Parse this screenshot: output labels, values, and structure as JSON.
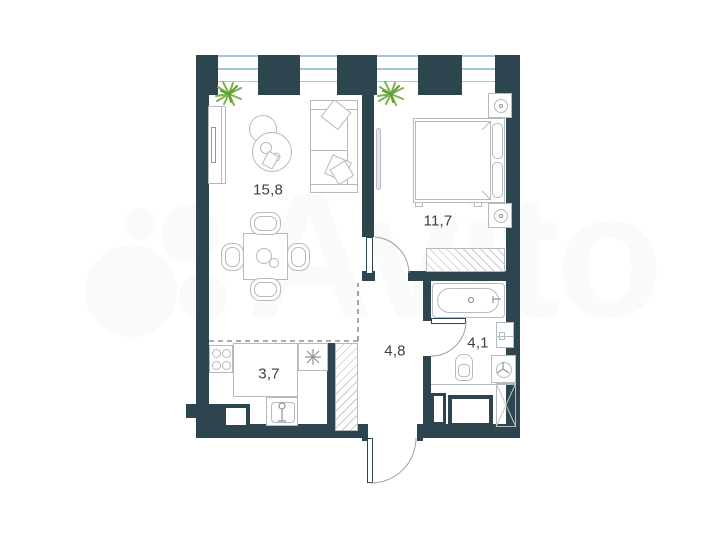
{
  "watermark": {
    "text": "Avito"
  },
  "rooms": {
    "living": {
      "area": "15,8"
    },
    "bedroom": {
      "area": "11,7"
    },
    "kitchen": {
      "area": "3,7"
    },
    "hallway": {
      "area": "4,8"
    },
    "bathroom": {
      "area": "4,1"
    }
  },
  "colors": {
    "wall": "#2c454e",
    "win": "#a3c6dc",
    "fur": "#b4babd",
    "det": "#8f979b",
    "label": "#3a4145",
    "plant": "#7cb34a",
    "dash": "#6f797d"
  }
}
